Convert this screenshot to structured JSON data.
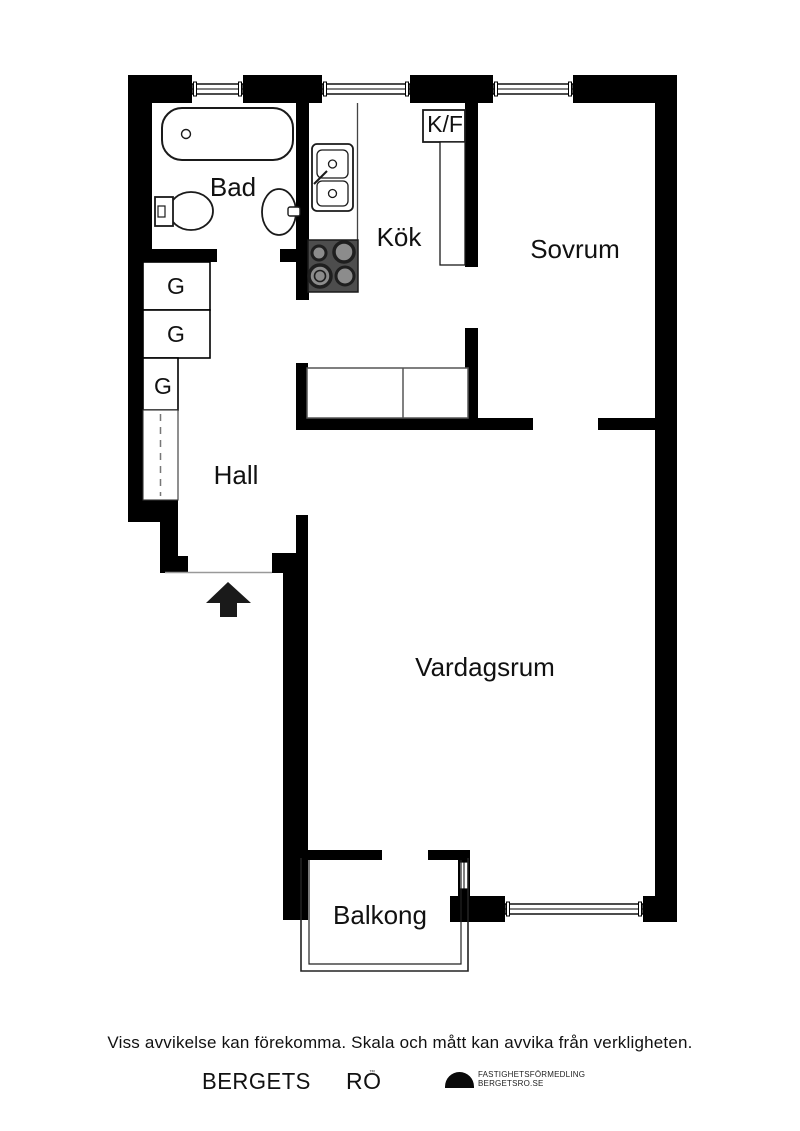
{
  "rooms": {
    "bathroom": "Bad",
    "kitchen": "Kök",
    "bedroom": "Sovrum",
    "hall": "Hall",
    "living_room": "Vardagsrum",
    "balcony": "Balkong"
  },
  "fixtures": {
    "fridge_freezer": "K/F",
    "closet": "G"
  },
  "footer": {
    "disclaimer": "Viss avvikelse kan förekomma. Skala och mått kan avvika från verkligheten.",
    "brand_primary": "BERGETS",
    "brand_secondary": "RO",
    "brand_mark": "™",
    "agency_line1": "FASTIGHETSFÖRMEDLING",
    "agency_line2": "BERGETSRO.SE"
  },
  "colors": {
    "wall": "#000000",
    "stove_top": "#4d4d4d",
    "furniture_line": "#555555"
  }
}
